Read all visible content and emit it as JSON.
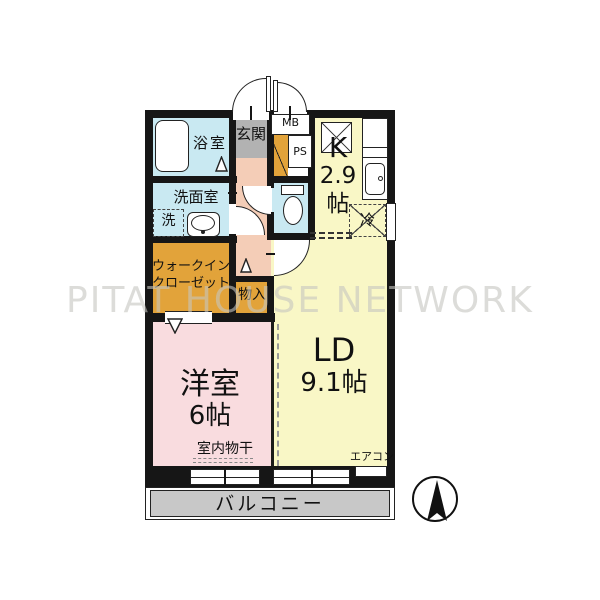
{
  "watermark": "PITAT HOUSE NETWORK",
  "rooms": {
    "bathroom": "浴室",
    "washroom": "洗面室",
    "washing_machine": "洗",
    "entrance": "玄関",
    "meter_box": "MB",
    "pipe_space": "PS",
    "kitchen": {
      "l1": "K",
      "l2": "2.9",
      "l3": "帖"
    },
    "refrigerator": "冷",
    "walk_in_closet": {
      "l1": "ウォークイン",
      "l2": "クローゼット"
    },
    "storage": "物入",
    "living_dining": {
      "l1": "LD",
      "l2": "9.1帖"
    },
    "western_room": {
      "l1": "洋室",
      "l2": "6帖"
    },
    "indoor_drying": "室内物干",
    "air_conditioner": "エアコン",
    "balcony": "バルコニー"
  },
  "colors": {
    "wall": "#161616",
    "wet": "#c9e9f2",
    "yellow": "#f9f7c6",
    "corridor": "#f4cdb7",
    "closet": "#e2a33a",
    "pink": "#f9dcdf",
    "egray": "#b2b2b2",
    "bgray": "#c8c8c8"
  }
}
